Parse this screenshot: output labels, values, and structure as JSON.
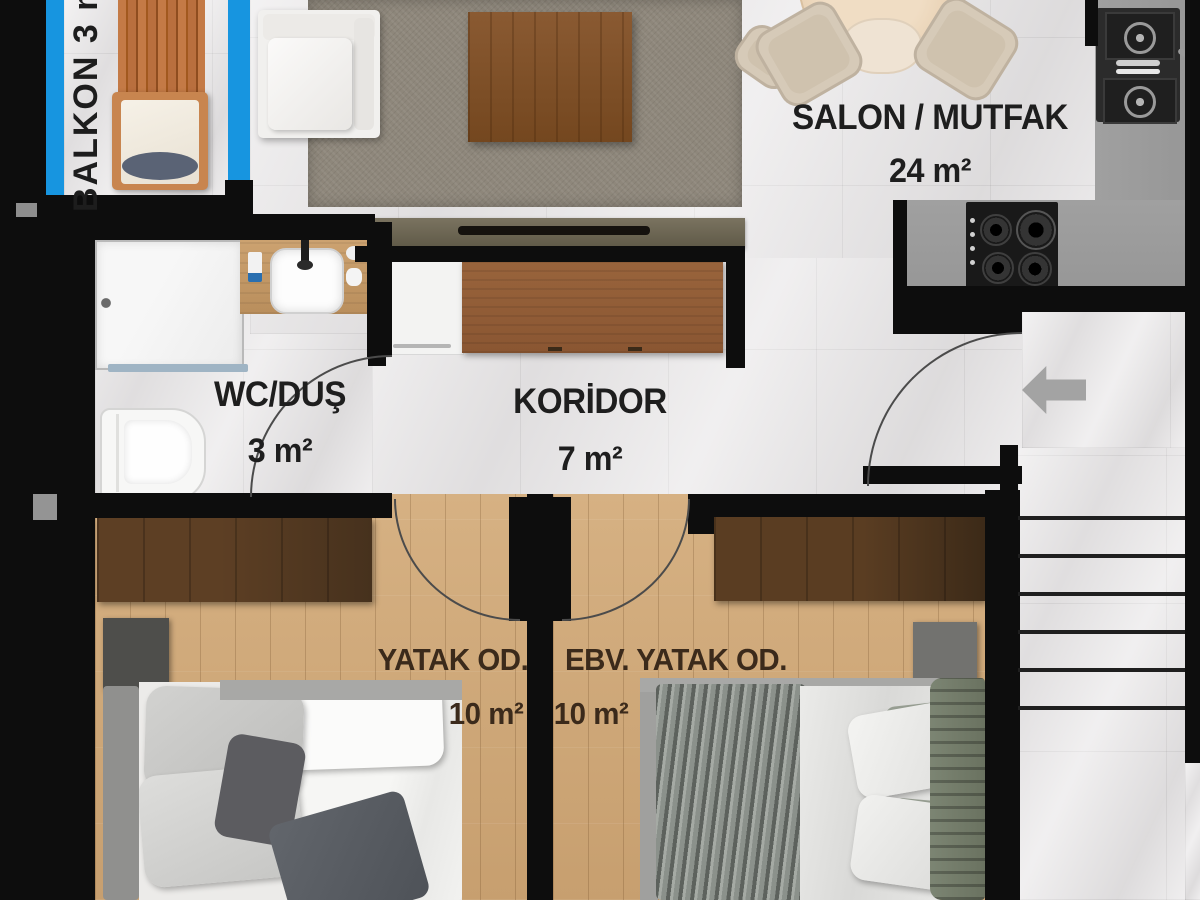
{
  "rooms": {
    "balkon": {
      "label": "BALKON 3 m²"
    },
    "salon_mutfak": {
      "label": "SALON / MUTFAK",
      "area": "24 m²"
    },
    "wc_dus": {
      "label": "WC/DUŞ",
      "area": "3 m²"
    },
    "koridor": {
      "label": "KORİDOR",
      "area": "7 m²"
    },
    "yatak_odasi": {
      "label": "YATAK OD.",
      "area": "10 m²"
    },
    "ebeveyn_yatak_odasi": {
      "label": "EBV. YATAK OD.",
      "area": "10 m²"
    }
  },
  "icons": {
    "entry_arrow": "left-arrow"
  },
  "colors": {
    "wall": "#0d0d0d",
    "window": "#1795e0",
    "tile": "#e9e7e8",
    "wood_floor": "#d6b183",
    "deck_wood": "#b96f3e",
    "wardrobe_dark": "#46311d",
    "wardrobe_brown": "#8a5632",
    "counter": "#979797",
    "rug": "#8e877b",
    "label_text": "#1e1e1e",
    "bedroom_label_text": "#3b2a1b"
  }
}
